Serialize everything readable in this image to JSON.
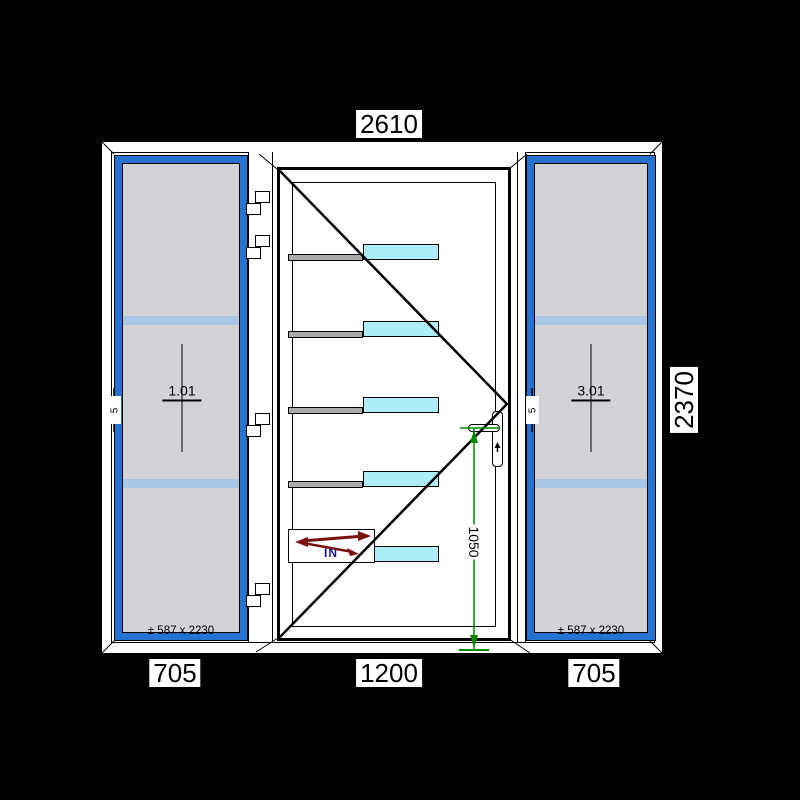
{
  "drawing": {
    "dimensions": {
      "overall_width": "2610",
      "overall_height": "2370",
      "left_sidelight_width": "705",
      "door_width": "1200",
      "right_sidelight_width": "705",
      "handle_height": "1050"
    },
    "left_sidelight": {
      "position_label": "1.01",
      "glass_size": "± 587 x 2230",
      "edge_marker": "5"
    },
    "right_sidelight": {
      "position_label": "3.01",
      "glass_size": "± 587 x 2230",
      "edge_marker": "5"
    },
    "door": {
      "opening_label": "IN"
    },
    "colors": {
      "background": "#000000",
      "frame_white": "#ffffff",
      "sash_blue": "#2473d0",
      "glass_gray": "#d3d3d7",
      "glass_band_blue": "#a9c6e6",
      "door_glass_cyan": "#aeeff7",
      "muntin_gray": "#ababab",
      "dimension_green": "#008a00",
      "swing_arrow_red": "#7a1012",
      "in_text_navy": "#16168c"
    }
  }
}
